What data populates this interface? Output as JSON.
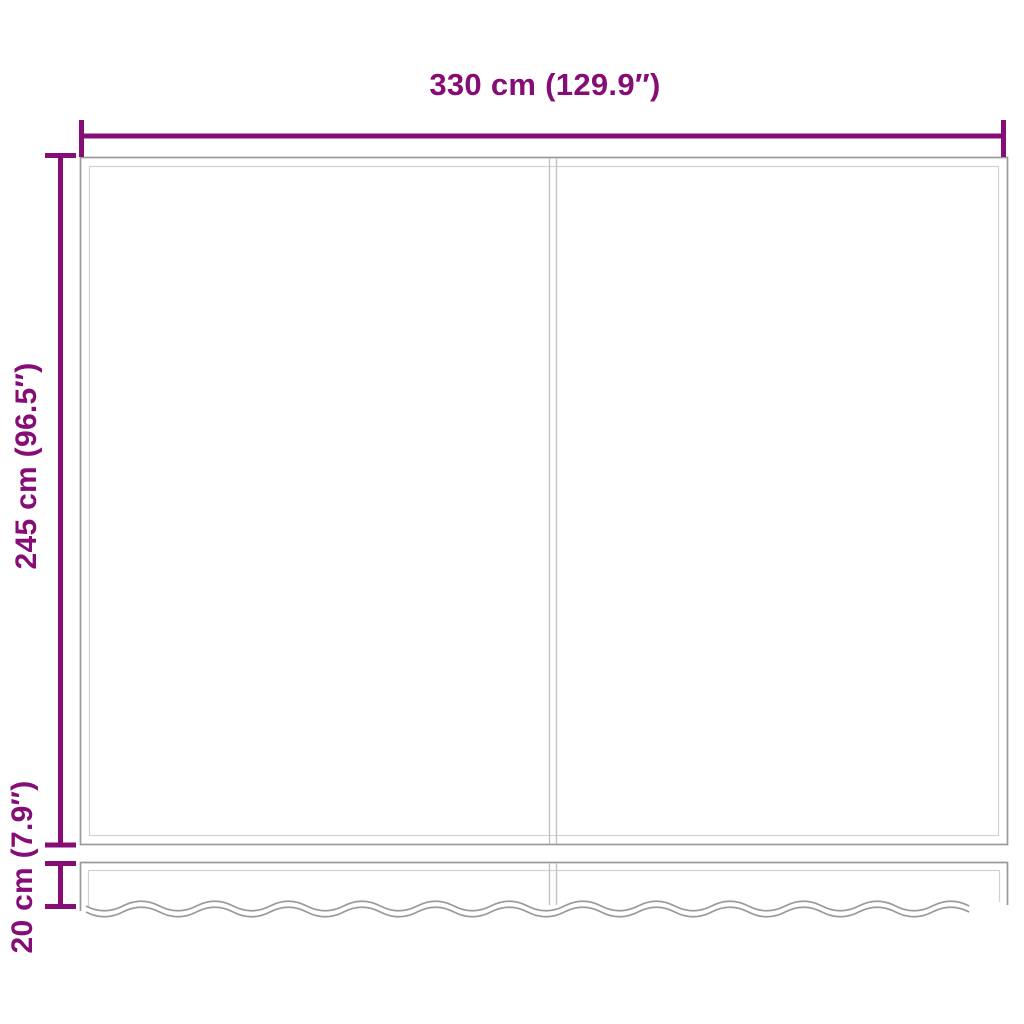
{
  "diagram": {
    "name": "awning-replacement-fabric-dimension-diagram",
    "dimensions": {
      "width": {
        "label": "330 cm (129.9″)",
        "value_cm": 330,
        "value_inch": 129.9
      },
      "height": {
        "label": "245 cm (96.5″)",
        "value_cm": 245,
        "value_inch": 96.5
      },
      "valance": {
        "label": "20 cm (7.9″)",
        "value_cm": 20,
        "value_inch": 7.9
      }
    }
  },
  "colors": {
    "accent": "#860D76",
    "strong": "#9a9a9a",
    "light": "#d2d2d2",
    "seam": "#c2c2c2",
    "bg": "#ffffff"
  }
}
